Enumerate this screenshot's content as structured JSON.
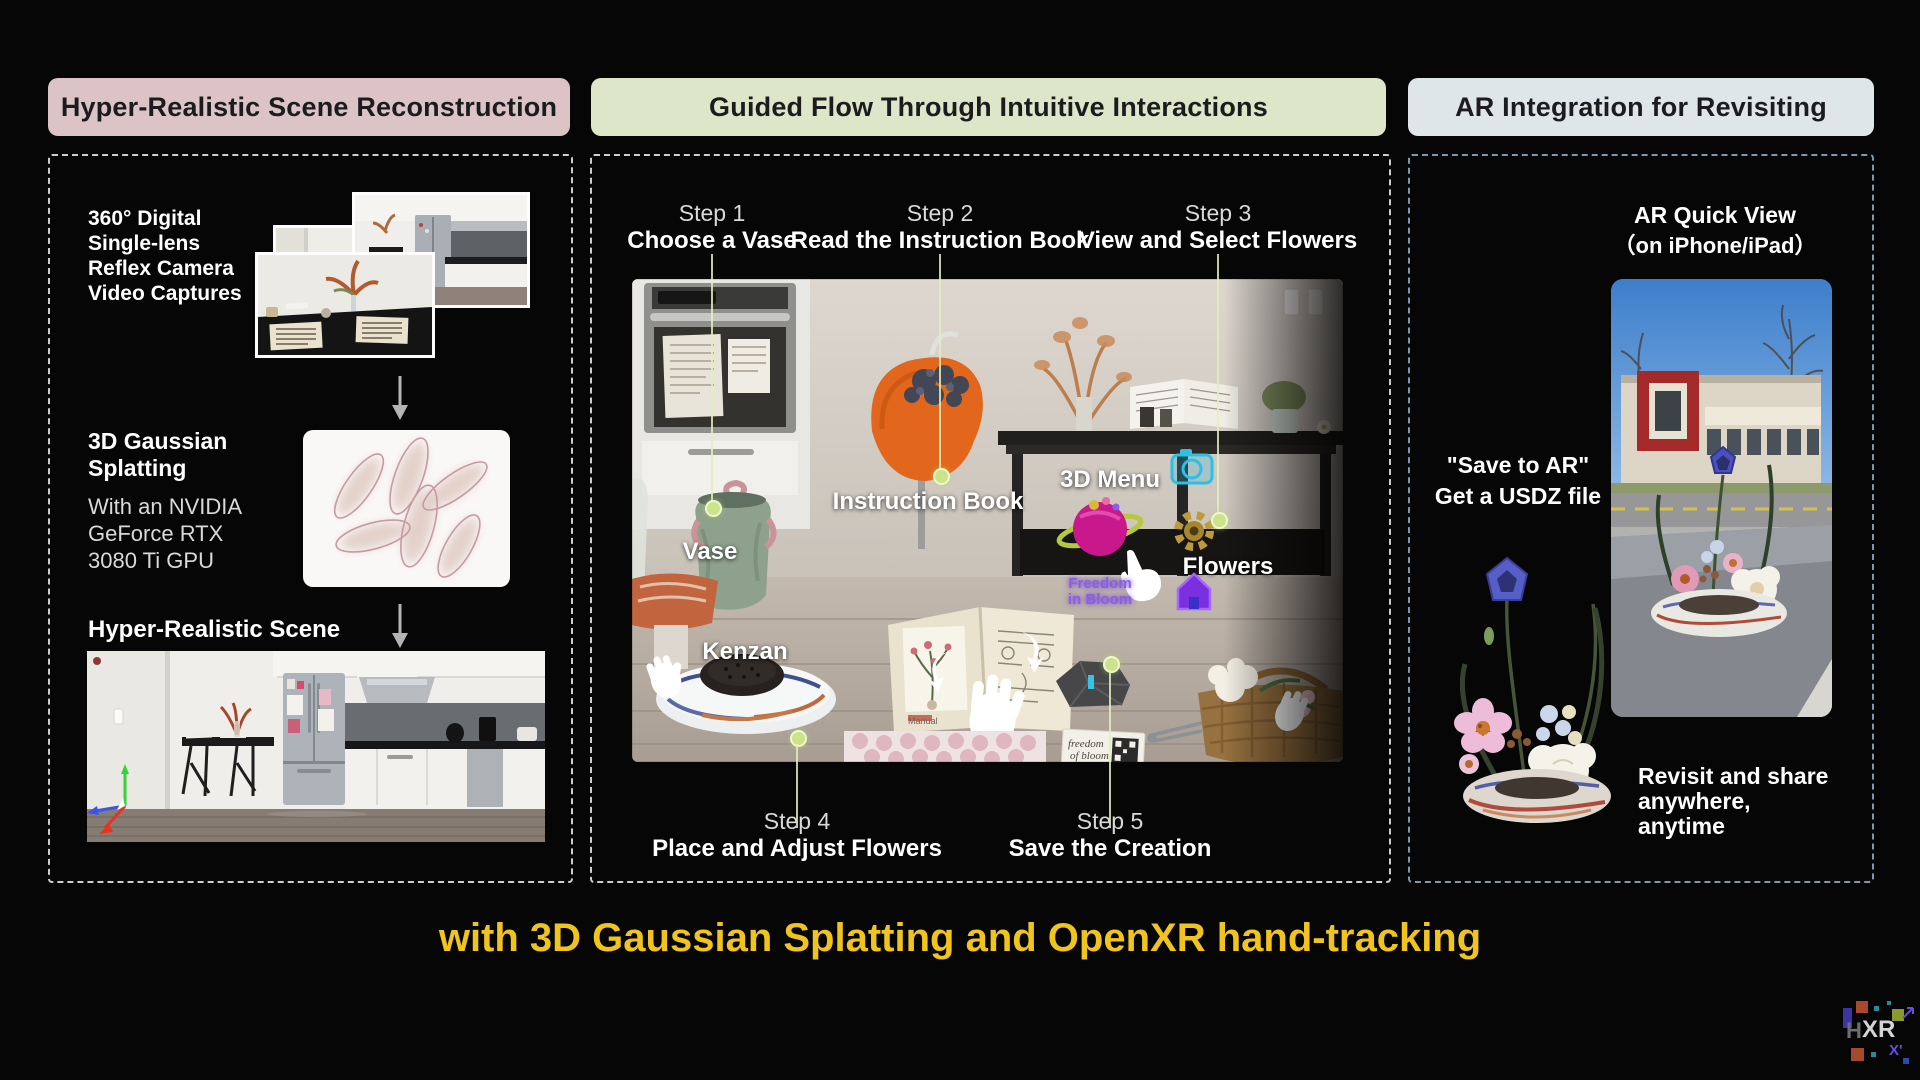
{
  "headers": {
    "left": "Hyper-Realistic Scene Reconstruction",
    "middle": "Guided Flow Through Intuitive Interactions",
    "right": "AR Integration for Revisiting"
  },
  "left_panel": {
    "capture_text": "360° Digital\nSingle-lens\nReflex Camera\nVideo Captures",
    "gaussian_title": "3D Gaussian\nSplatting",
    "gaussian_sub": "With an NVIDIA\nGeForce RTX\n3080 Ti GPU",
    "scene_label": "Hyper-Realistic Scene"
  },
  "middle_panel": {
    "steps_top": [
      {
        "step": "Step 1",
        "label": "Choose a Vase"
      },
      {
        "step": "Step 2",
        "label": "Read the Instruction Book"
      },
      {
        "step": "Step 3",
        "label": "View and Select Flowers"
      }
    ],
    "steps_bottom": [
      {
        "step": "Step 4",
        "label": "Place and Adjust Flowers"
      },
      {
        "step": "Step 5",
        "label": "Save the Creation"
      }
    ],
    "scene_labels": {
      "vase": "Vase",
      "instruction_book": "Instruction Book",
      "kenzan": "Kenzan",
      "menu": "3D Menu",
      "flowers": "Flowers"
    },
    "scene_texts": {
      "menu_app": "Freedom\nin Bloom",
      "card_line1": "freedom",
      "card_line2": "of bloom",
      "book_label": "Manual"
    }
  },
  "right_panel": {
    "title": "AR Quick View",
    "subtitle": "（on iPhone/iPad）",
    "save_text": "\"Save to AR\"\nGet a USDZ file",
    "revisit_text": "Revisit and share\nanywhere,\nanytime"
  },
  "caption": "with 3D Gaussian Splatting and OpenXR hand-tracking",
  "logo": {
    "h": "H",
    "xr": "XR",
    "xprime": "X'"
  },
  "icons": {
    "arrow_down": "down-arrow",
    "camera": "camera-3d-menu-icon",
    "gear": "gear-3d-menu-icon",
    "home": "home-3d-menu-icon",
    "planet": "planet-app-icon",
    "hand": "vr-hand"
  },
  "colors": {
    "header_left_bg": "#dcc3c5",
    "header_middle_bg": "#dde6c8",
    "header_right_bg": "#dfe6ea",
    "caption_yellow": "#f0c41e",
    "step_guide_green": "#cbe489",
    "right_border_blue": "#7e99ad"
  }
}
